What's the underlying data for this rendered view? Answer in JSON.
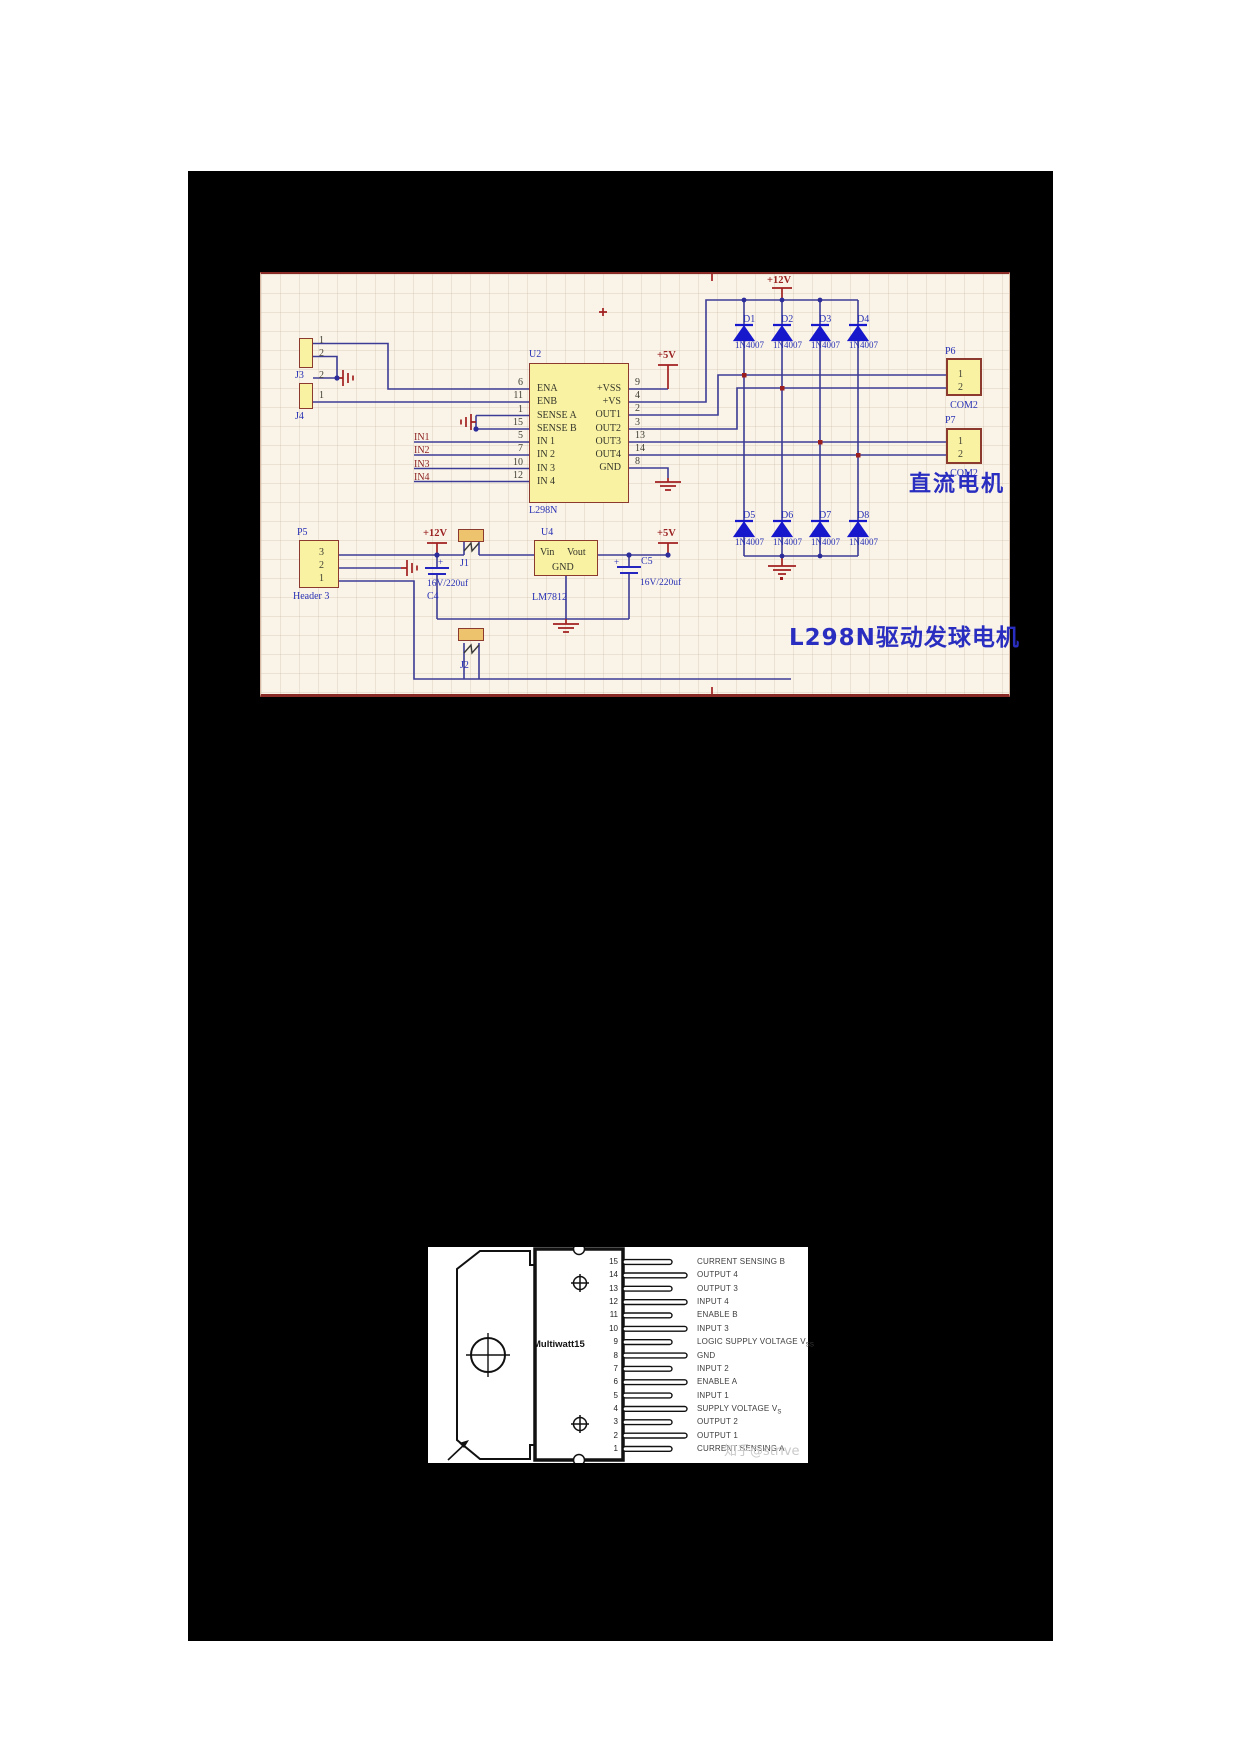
{
  "colors": {
    "canvas": "#faf4e8",
    "component_fill": "#f8f2a2",
    "component_border": "#8c3a2e",
    "wire_blue": "#3c3c96",
    "diode_blue": "#1717cc",
    "power_red": "#a02020",
    "label_blue": "#2830b4",
    "panel_black": "#000000"
  },
  "schematic": {
    "power": {
      "v12": "+12V",
      "v5": "+5V"
    },
    "u2": {
      "designator": "U2",
      "part": "L298N",
      "left_pins": [
        {
          "num": "6",
          "name": "ENA"
        },
        {
          "num": "11",
          "name": "ENB"
        },
        {
          "num": "1",
          "name": "SENSE A"
        },
        {
          "num": "15",
          "name": "SENSE B"
        },
        {
          "num": "5",
          "name": "IN 1"
        },
        {
          "num": "7",
          "name": "IN 2"
        },
        {
          "num": "10",
          "name": "IN 3"
        },
        {
          "num": "12",
          "name": "IN 4"
        }
      ],
      "right_pins": [
        {
          "num": "9",
          "name": "+VSS"
        },
        {
          "num": "4",
          "name": "+VS"
        },
        {
          "num": "2",
          "name": "OUT1"
        },
        {
          "num": "3",
          "name": "OUT2"
        },
        {
          "num": "13",
          "name": "OUT3"
        },
        {
          "num": "14",
          "name": "OUT4"
        },
        {
          "num": "8",
          "name": "GND"
        }
      ]
    },
    "u4": {
      "designator": "U4",
      "part": "LM7812",
      "vin": "Vin",
      "vout": "Vout",
      "gnd": "GND"
    },
    "j1": {
      "designator": "J1"
    },
    "j2": {
      "designator": "J2"
    },
    "j3": {
      "designator": "J3",
      "pins": [
        "1",
        "2"
      ]
    },
    "j4": {
      "designator": "J4",
      "pins": [
        "2",
        "1"
      ]
    },
    "p5": {
      "designator": "P5",
      "pins": [
        "3",
        "2",
        "1"
      ],
      "label": "Header 3"
    },
    "p6": {
      "designator": "P6",
      "pins": [
        "1",
        "2"
      ],
      "label": "COM2"
    },
    "p7": {
      "designator": "P7",
      "pins": [
        "1",
        "2"
      ],
      "label": "COM2"
    },
    "c4": {
      "designator": "C4",
      "value": "16V/220uf",
      "polarity": "+"
    },
    "c5": {
      "designator": "C5",
      "value": "16V/220uf",
      "polarity": "+"
    },
    "diodes": [
      {
        "name": "D1",
        "part": "1N4007"
      },
      {
        "name": "D2",
        "part": "1N4007"
      },
      {
        "name": "D3",
        "part": "1N4007"
      },
      {
        "name": "D4",
        "part": "1N4007"
      },
      {
        "name": "D5",
        "part": "1N4007"
      },
      {
        "name": "D6",
        "part": "1N4007"
      },
      {
        "name": "D7",
        "part": "1N4007"
      },
      {
        "name": "D8",
        "part": "1N4007"
      }
    ],
    "nets": [
      "IN1",
      "IN2",
      "IN3",
      "IN4"
    ],
    "title_right": "直流电机",
    "title_bottom": "L298N驱动发球电机"
  },
  "pinout": {
    "package": "Multiwatt15",
    "watermark": "知乎@strive",
    "pins": [
      {
        "num": "15",
        "label": "CURRENT SENSING B"
      },
      {
        "num": "14",
        "label": "OUTPUT 4"
      },
      {
        "num": "13",
        "label": "OUTPUT 3"
      },
      {
        "num": "12",
        "label": "INPUT 4"
      },
      {
        "num": "11",
        "label": "ENABLE B"
      },
      {
        "num": "10",
        "label": "INPUT 3"
      },
      {
        "num": "9",
        "label": "LOGIC SUPPLY VOLTAGE V",
        "sub": "SS"
      },
      {
        "num": "8",
        "label": "GND"
      },
      {
        "num": "7",
        "label": "INPUT 2"
      },
      {
        "num": "6",
        "label": "ENABLE A"
      },
      {
        "num": "5",
        "label": "INPUT 1"
      },
      {
        "num": "4",
        "label": "SUPPLY VOLTAGE V",
        "sub": "S"
      },
      {
        "num": "3",
        "label": "OUTPUT 2"
      },
      {
        "num": "2",
        "label": "OUTPUT 1"
      },
      {
        "num": "1",
        "label": "CURRENT SENSING A"
      }
    ]
  }
}
